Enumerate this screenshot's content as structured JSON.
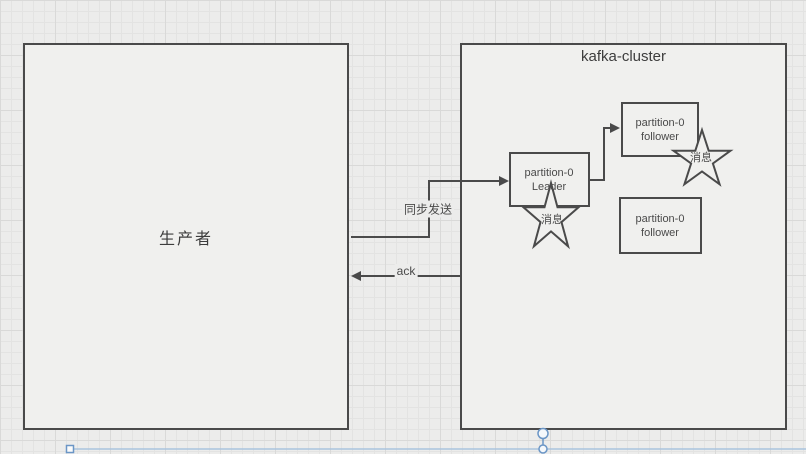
{
  "colors": {
    "background": "#ececeb",
    "grid_minor": "#e3e3e2",
    "grid_major": "#d9d9d8",
    "shape_fill": "#f0f0ee",
    "shape_stroke": "#4a4a4a",
    "selection_blue": "#6b96c6",
    "selection_blue_light": "#aac3de"
  },
  "producer": {
    "label": "生产者"
  },
  "cluster": {
    "title": "kafka-cluster"
  },
  "nodes": {
    "leader": {
      "line1": "partition-0",
      "line2": "Leader"
    },
    "follower_top": {
      "line1": "partition-0",
      "line2": "follower"
    },
    "follower_bottom": {
      "line1": "partition-0",
      "line2": "follower"
    }
  },
  "stars": {
    "leader_message": "消息",
    "follower_message": "消息"
  },
  "edges": {
    "sync": "同步发送",
    "ack": "ack"
  }
}
